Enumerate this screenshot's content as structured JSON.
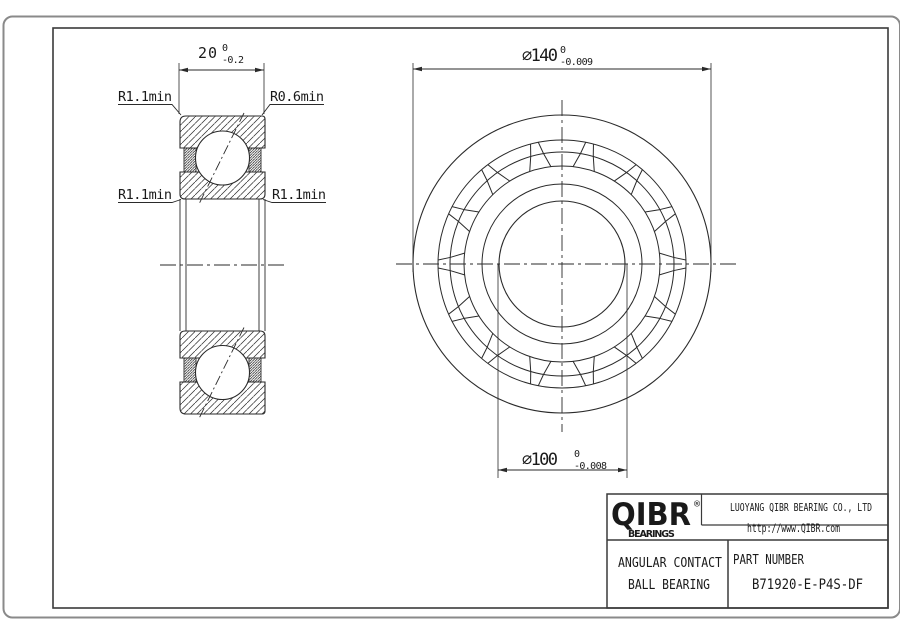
{
  "drawing": {
    "section_view": {
      "width_dim": {
        "value": "20",
        "tol_upper": "0",
        "tol_lower": "-0.2"
      },
      "labels": {
        "top_left": "R1.1min",
        "top_right": "R0.6min",
        "bottom_left": "R1.1min",
        "bottom_right": "R1.1min"
      }
    },
    "front_view": {
      "outer_dia": {
        "value": "⌀140",
        "tol_upper": "0",
        "tol_lower": "-0.009"
      },
      "bore_dia": {
        "value": "⌀100",
        "tol_upper": "0",
        "tol_lower": "-0.008"
      }
    }
  },
  "title_block": {
    "logo": {
      "text": "QIBR",
      "registered": "®",
      "sub": "BEARINGS"
    },
    "company": "LUOYANG QIBR BEARING CO., LTD",
    "website": "http://www.QIBR.com",
    "product_line1": "ANGULAR CONTACT",
    "product_line2": "BALL BEARING",
    "part_number_label": "PART NUMBER",
    "part_number": "B71920-E-P4S-DF"
  },
  "colors": {
    "line": "#2a2a2a",
    "frame": "#3a3a3a",
    "outer_border": "#8a8a8a",
    "background": "#ffffff"
  }
}
